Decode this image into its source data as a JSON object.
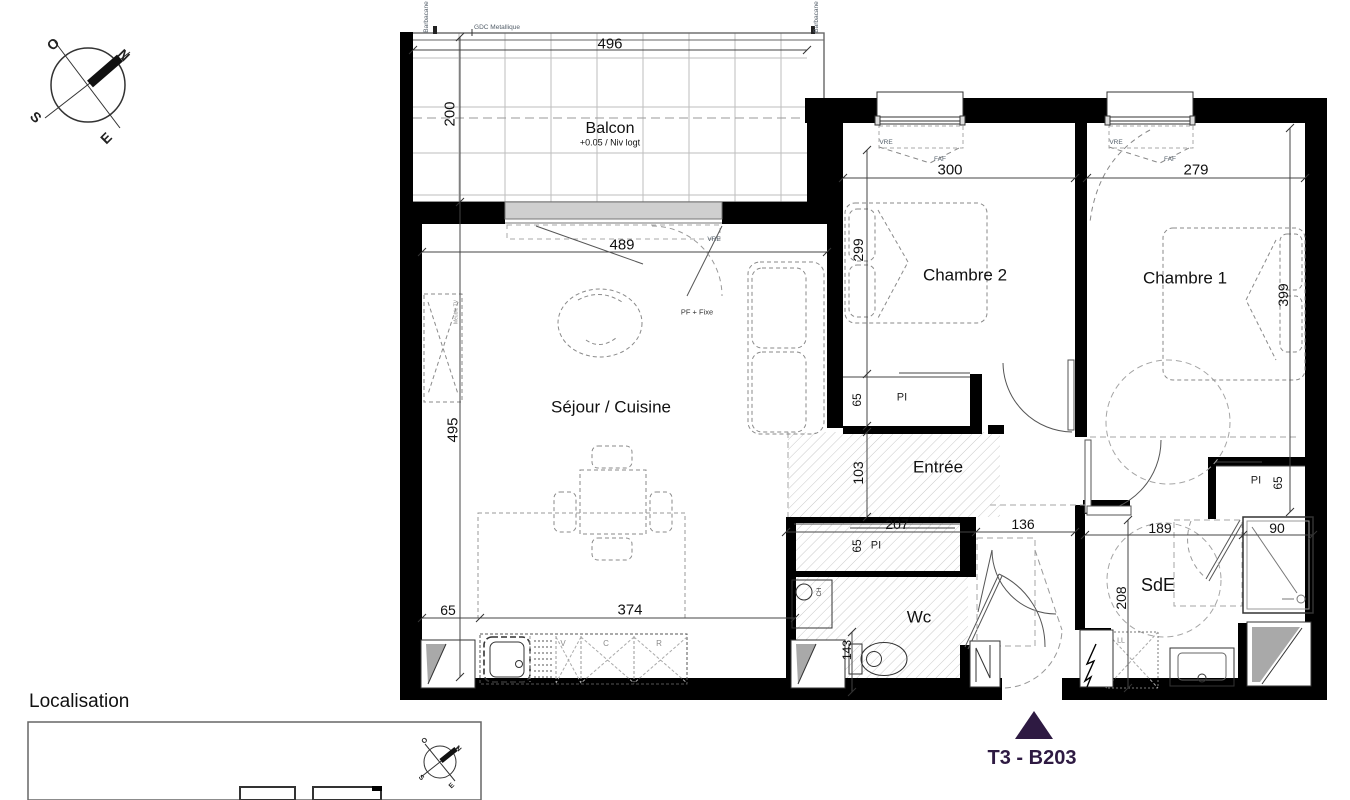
{
  "compass": {
    "n": "N",
    "s": "S",
    "e": "E",
    "o": "O"
  },
  "header": {
    "barbacane_left": "Barbacane",
    "barbacane_right": "Barbacane",
    "gdc": "GDC Metallique"
  },
  "rooms": {
    "balcony": {
      "name": "Balcon",
      "level": "+0.05 / Niv logt",
      "width": "496",
      "depth": "200",
      "door_width": "489",
      "window_label": "VRE",
      "door_label": "PF + Fixe"
    },
    "living": {
      "name": "Séjour / Cuisine",
      "depth": "495",
      "kitchen_left": "65",
      "kitchen_width": "374",
      "cab_v": "V",
      "cab_c": "C",
      "cab_r": "R",
      "tv_unit": "Meuble TV"
    },
    "bedroom2": {
      "name": "Chambre 2",
      "width": "300",
      "depth": "299",
      "closet": "PI",
      "closet_depth": "65",
      "window_label": "VRE",
      "shutter_label": "FAF"
    },
    "bedroom1": {
      "name": "Chambre 1",
      "width": "279",
      "depth": "399",
      "closet": "PI",
      "closet_depth": "65",
      "window_label": "VRE",
      "shutter_label": "FAF"
    },
    "entry": {
      "name": "Entrée",
      "depth": "103",
      "closet_width": "207",
      "closet_depth": "65",
      "closet": "PI",
      "width": "136"
    },
    "wc": {
      "name": "Wc",
      "width": "143",
      "boiler": "CH"
    },
    "shower_room": {
      "name": "SdE",
      "width": "189",
      "shower_width": "90",
      "depth": "208",
      "washer": "LL"
    }
  },
  "footer": {
    "localisation": "Localisation",
    "unit": "T3 - B203",
    "accent_color": "#2e1a42"
  }
}
